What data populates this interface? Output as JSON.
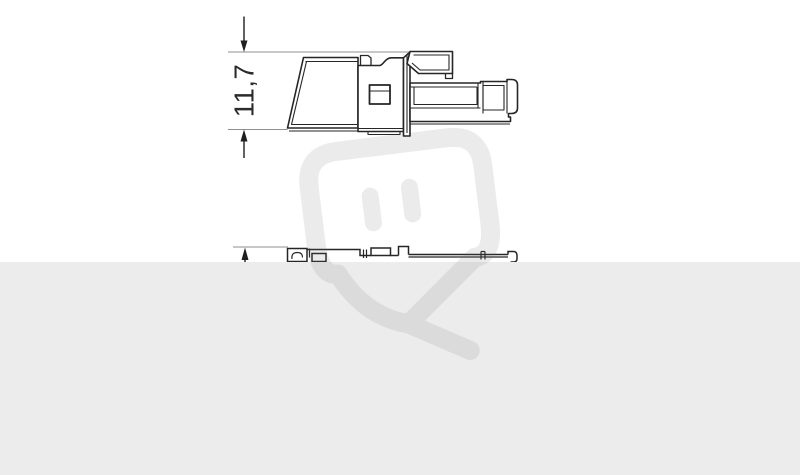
{
  "drawing": {
    "dimension_label": "11,7",
    "views": [
      {
        "name": "connector side view with latch lever and plug shaft"
      },
      {
        "name": "connector top profile, partially hidden by gray panel"
      }
    ]
  },
  "watermark": {
    "icon": "plug-logo-watermark",
    "opacity": 0.13
  },
  "colors": {
    "background": "#ffffff",
    "panel": "#ececec",
    "line": "#262626",
    "inner_line": "#2e2e2e",
    "extension_line": "#8f8f8f",
    "dimension_ink": "#1f1f1f",
    "dimension_text": "#2b2b2b",
    "watermark_gray": "#6e6e6e",
    "fill_white": "#ffffff"
  }
}
